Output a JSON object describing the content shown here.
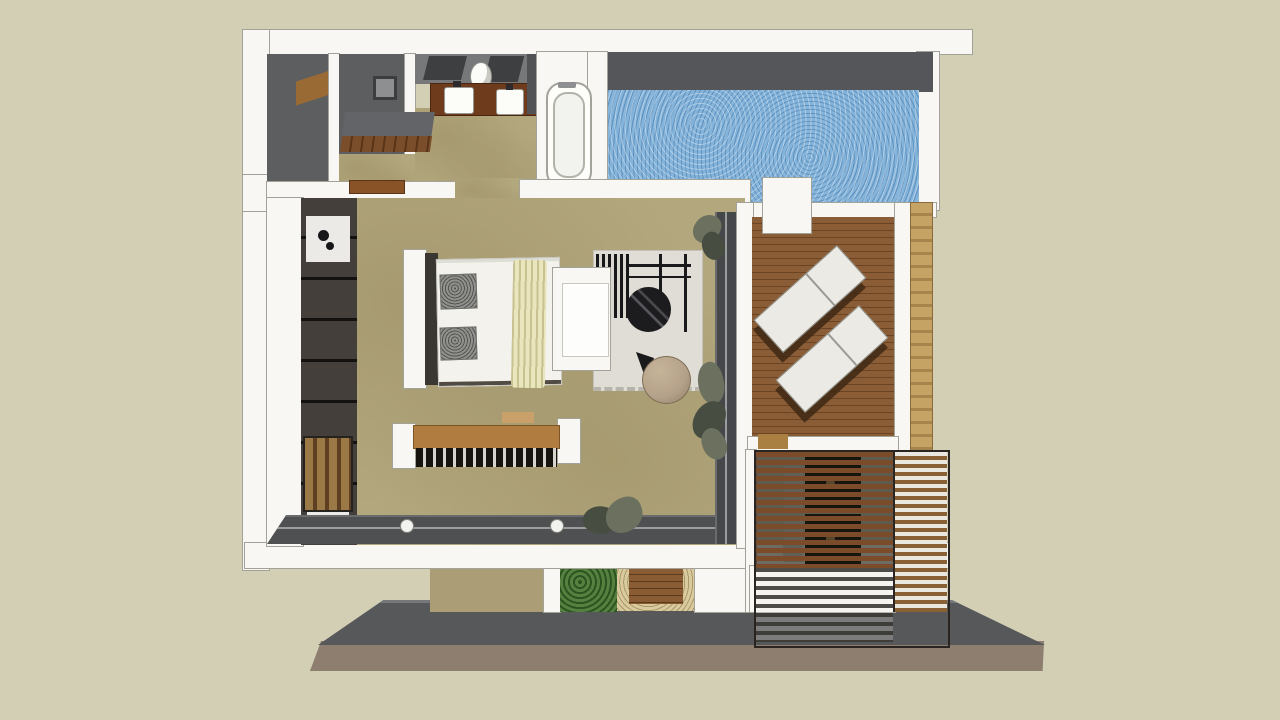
{
  "scene": {
    "type": "3d-floorplan-render",
    "view": "overhead axonometric cutaway of a one-bedroom pool villa",
    "areas": [
      {
        "name": "bathroom",
        "features": [
          "toilet room",
          "walk-in shower with floor drain",
          "shower bench",
          "double-sink timber vanity",
          "round vessel basin",
          "two tilted wall mirrors",
          "freestanding bathtub",
          "luggage bench"
        ]
      },
      {
        "name": "bedroom",
        "features": [
          "double bed with two gray pillows and cream throw",
          "white headboard panel",
          "wardrobe column with shelves",
          "minibar cabinet",
          "wall-mounted tv",
          "foot bench with timber beam and slatted base",
          "sliding glass doors with round handles",
          "corner plants"
        ]
      },
      {
        "name": "lounge-corner",
        "features": [
          "light area rug with fringe",
          "white chaise",
          "black-and-white striped slat chair",
          "round black coffee table",
          "tan knitted pouf"
        ]
      },
      {
        "name": "pool",
        "features": [
          "textured blue water surface",
          "dark back wall",
          "white coping edge",
          "white entry platform"
        ]
      },
      {
        "name": "deck",
        "features": [
          "horizontal timber plank decking",
          "two white sun loungers set diagonally",
          "stone pillar wall strip"
        ]
      },
      {
        "name": "pergola",
        "features": [
          "brown timber slat roof",
          "white slat screen column",
          "dark outdoor furniture seen through slats"
        ]
      },
      {
        "name": "exterior",
        "features": [
          "gray terrace walkway with beveled corners",
          "brown plinth base",
          "green hedge panel",
          "timber entry step with gravel surround",
          "tan exterior wall panel"
        ]
      }
    ]
  },
  "palette": {
    "bg": "#d2cfb4",
    "wall": "#f8f7f3",
    "wall_edge": "#a3a299",
    "white_soft": "#eceae4",
    "dark_room": "#5d5e60",
    "dark_face": "#4b4c4e",
    "wardrobe": "#443f3a",
    "floor_tan": "#b3a77d",
    "pool": "#84b4da",
    "deck": "#8a5d36",
    "deck_line": "#6b4424",
    "counter": "#6f3b1d",
    "bench_wood": "#b07c40",
    "slat": "#7b4c2a",
    "slat_gap": "#26211d",
    "white_slat": "#e9e7e0",
    "stone": "#c4a365",
    "stone_band": "#a5854b",
    "terrace": "#57585a",
    "terrace_lip": "#76777a",
    "base": "#8d7e6f",
    "hedge": "#55803f",
    "gravel": "#d9cb9d",
    "rug": "#dfddd5",
    "pouf": "#b4a189",
    "black": "#1c1c1f",
    "throw": "#e9e5bd",
    "plant": "#6c705f",
    "plant_dark": "#474e41"
  }
}
